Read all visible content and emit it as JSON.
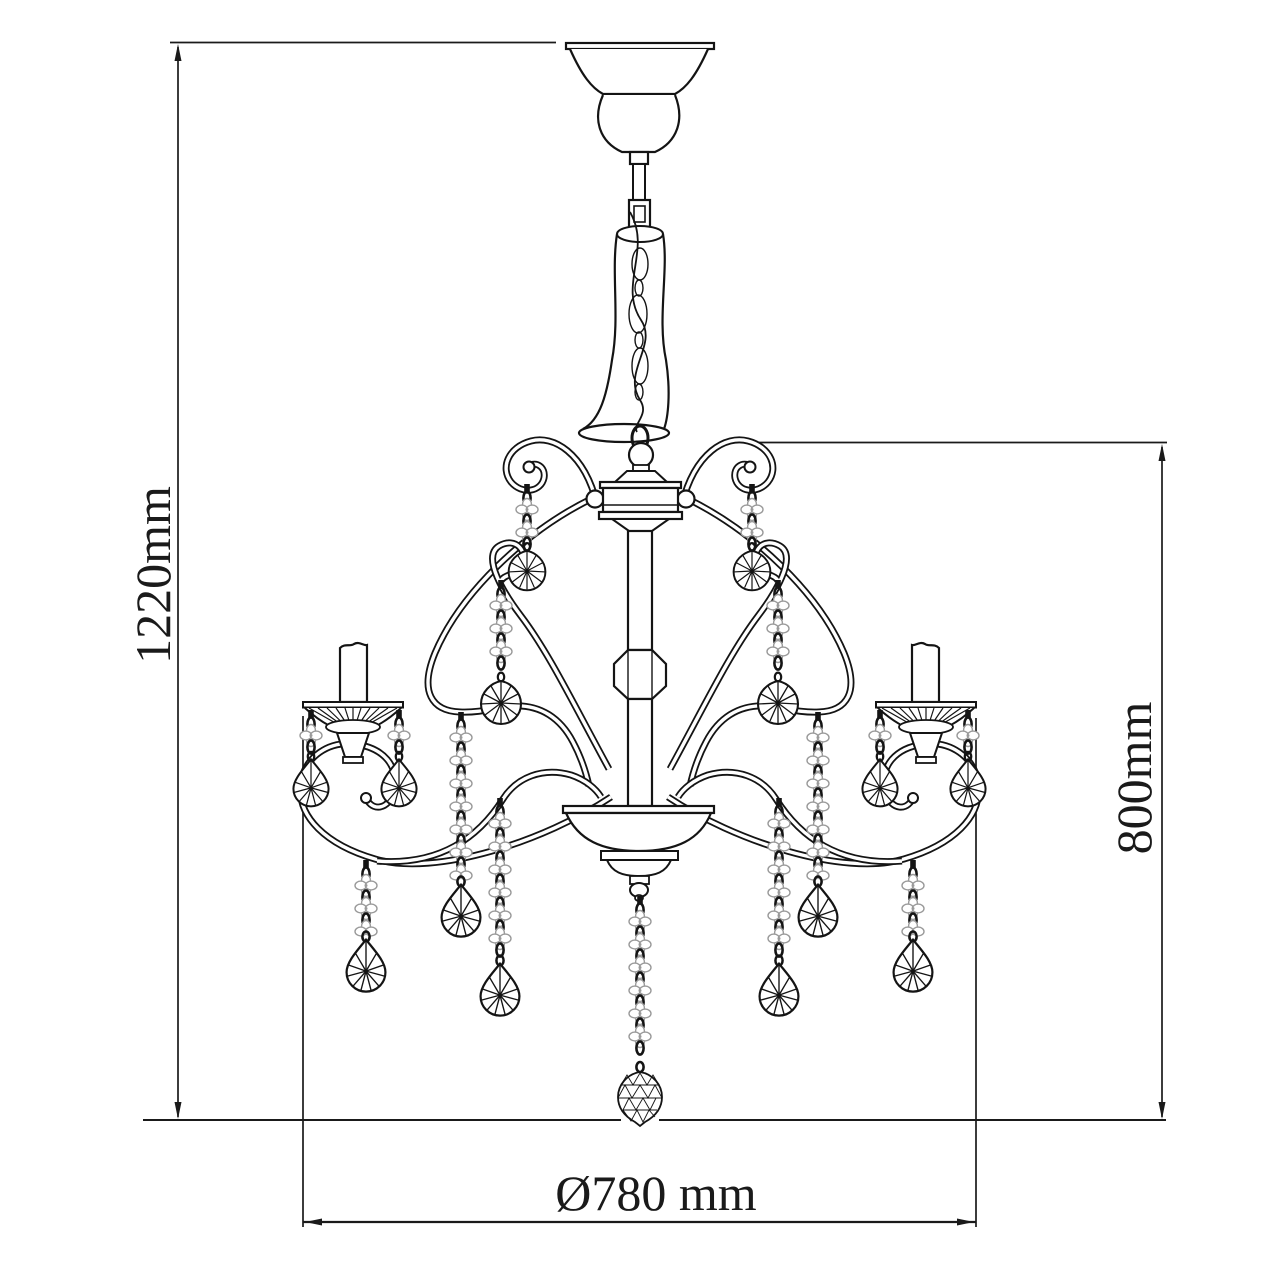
{
  "meta": {
    "background": "#ffffff",
    "ink": "#141414",
    "bead_gray": "#9a9a9a"
  },
  "labels": {
    "overall_height": "1220mm",
    "fixture_height": "800mm",
    "diameter": "Ø780 mm"
  }
}
